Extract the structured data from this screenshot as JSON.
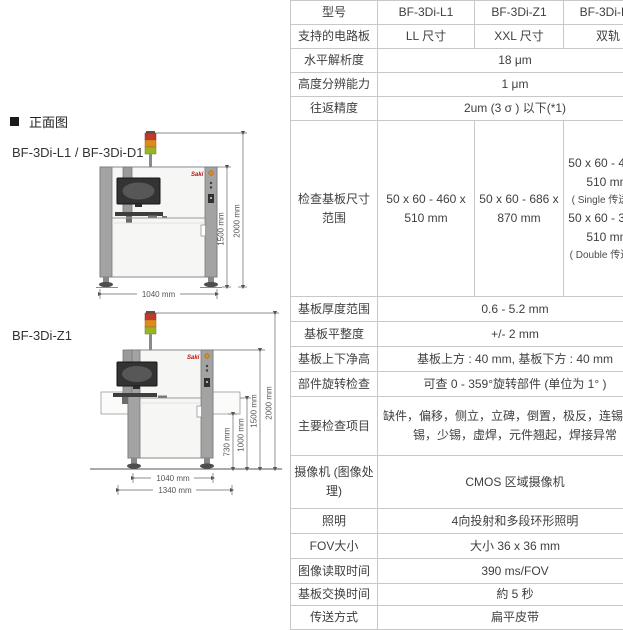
{
  "page": {
    "background": "#ffffff"
  },
  "brand": {
    "name": "Saki",
    "color": "#c11212"
  },
  "left_panel": {
    "section_title": "正面图",
    "machine1_label": "BF-3Di-L1 / BF-3Di-D1",
    "machine2_label": "BF-3Di-Z1",
    "signal_tower_colors": {
      "top": "#c0392b",
      "middle": "#e08a1e",
      "bottom": "#9ab522"
    },
    "machine1_dimensions": {
      "width": "1040 mm",
      "machine_height": "1500 mm",
      "total_height": "2000 mm"
    },
    "machine2_dimensions": {
      "conveyor_height": "730 mm",
      "extension_height": "1000 mm",
      "machine_height": "1500 mm",
      "total_height": "2000 mm",
      "base_width": "1040 mm",
      "total_width": "1340 mm"
    }
  },
  "spec_table": {
    "border_color": "#c8c8c8",
    "rows": {
      "model": {
        "label": "型号",
        "l1": "BF-3Di-L1",
        "z1": "BF-3Di-Z1",
        "d1": "BF-3Di-D1"
      },
      "supported_board": {
        "label": "支持的电路板",
        "l1": "LL 尺寸",
        "z1": "XXL 尺寸",
        "d1": "双轨"
      },
      "horizontal_resolution": {
        "label": "水平解析度",
        "value": "18 μm"
      },
      "height_resolution": {
        "label": "高度分辨能力",
        "value": "1 μm"
      },
      "repeat_accuracy": {
        "label": "往返精度",
        "value": "2um (3 σ ) 以下(*1)"
      },
      "board_size_range": {
        "label": "检查基板尺寸范围",
        "l1": "50 x 60 - 460 x 510 mm",
        "z1": "50 x 60 - 686 x 870 mm",
        "d1_single_size": "50 x 60 - 460 x 510 mm",
        "d1_single_note": "( Single 传送时 )",
        "d1_double_size": "50 x 60 - 320 x 510 mm",
        "d1_double_note": "( Double 传送时 )"
      },
      "board_thickness": {
        "label": "基板厚度范围",
        "value": "0.6 - 5.2 mm"
      },
      "board_flatness": {
        "label": "基板平整度",
        "value": "+/- 2 mm"
      },
      "board_clearance": {
        "label": "基板上下净高",
        "value": "基板上方 : 40 mm, 基板下方 : 40 mm"
      },
      "rotation_check": {
        "label": "部件旋转检查",
        "value": "可查 0 - 359°旋转部件 (单位为 1° )"
      },
      "main_check_items": {
        "label": "主要检查项目",
        "value": "缺件，偏移，侧立，立碑，倒置，极反，连锡，无锡，少锡，虚焊，元件翘起，焊接异常"
      },
      "camera": {
        "label": "摄像机 (图像处理)",
        "value": "CMOS 区域摄像机"
      },
      "lighting": {
        "label": "照明",
        "value": "4向投射和多段环形照明"
      },
      "fov": {
        "label": "FOV大小",
        "value": "大小 36 x 36 mm"
      },
      "image_read_time": {
        "label": "图像读取时间",
        "value": "390 ms/FOV"
      },
      "board_exchange_time": {
        "label": "基板交换时间",
        "value": "約 5 秒"
      },
      "transfer_method": {
        "label": "传送方式",
        "value": "扁平皮带"
      }
    }
  }
}
